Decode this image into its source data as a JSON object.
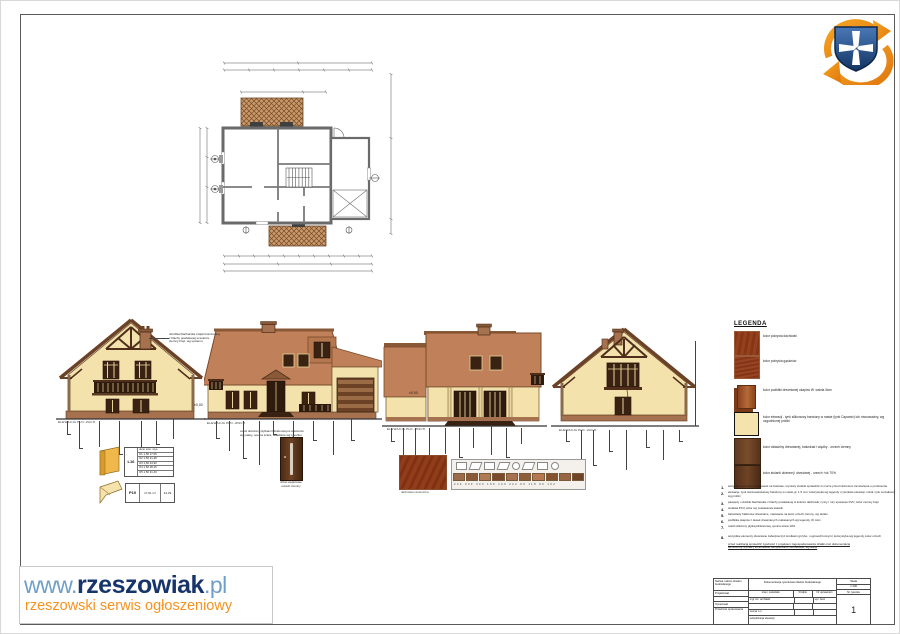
{
  "colors": {
    "roof": "#c0815a",
    "wall": "#f4e2ac",
    "timber": "#4f2f1b",
    "plinth": "#a5714e",
    "brand_navy": "#17356b",
    "brand_blue": "#6f9ec9",
    "brand_orange": "#f6921e"
  },
  "watermark": {
    "www": "www.",
    "brand": "rzeszowiak",
    "tld": ".pl",
    "tagline": "rzeszowski serwis ogłoszeniowy"
  },
  "legend": {
    "title": "LEGENDA",
    "items": [
      {
        "label": "kolor pokrycia dachówki"
      },
      {
        "label": "kolor pokrycia gąsiorów"
      },
      {
        "label": "kolor podbitki drewnianej okapów W. wiśnia /klon"
      },
      {
        "label": "kolor elewacji - tynk silikonowy barwiony w masie (tynk Capamix) lub równoważny, wg uzgodnionej próbki"
      },
      {
        "label": "kolor okładziny drewnianej, balustrad i więźby - orzech ciemny"
      },
      {
        "label": "kolor stolarki okiennej i drzwiowej - orzech +ok 70%"
      }
    ]
  },
  "notes": {
    "items": [
      {
        "num": "1.",
        "text": "wszystkie wymiary weryfikować na budowie; wymiary stolarki sprawdzić w murze przed złożeniem zamówienia u producenta"
      },
      {
        "num": "2.",
        "text": "elewacje: tynk cienkowarstwowy barwiony w masie gr. 1,5 mm; kolorystyka wg legendy i rysunków elewacji; cokół: tynk mozaikowy wg próbki"
      },
      {
        "num": "3.",
        "text": "parapety i obróbki blacharskie z blachy powlekanej w kolorze dachówki; rynny i rury spustowe PVC, kolor ciemny brąz"
      },
      {
        "num": "4.",
        "text": "stolarka PCV, kolor wg zestawienia stolarki"
      },
      {
        "num": "5.",
        "text": "balustrady balkonów drewniane, malowane na kolor orzech ciemny, wg detalu"
      },
      {
        "num": "6.",
        "text": "podbitka okapów z desek drewnianych malowanych wg legendy, W. klon"
      },
      {
        "num": "7.",
        "text": "cokół obłożony płytką klinkierową, spoina szara 10%"
      },
      {
        "num": "8.",
        "text": "wszystkie elementy drewniane zabezpieczyć środkami grzybo- i ognioochronnymi; kolorystyka wg legendy, kolor orzech"
      }
    ],
    "footer": [
      "przed realizacją sprawdzić zgodność z projektem zagospodarowania działki oraz dokumentacją",
      "techniczną; wymiary kontrolować bezpośrednio na budowie, wg stanu"
    ]
  },
  "titleblock": {
    "owner_header": "Nazwa i adres obiektu budowlanego",
    "doc_title": "Dokumentacja rysunkowa obiektu budowlanego",
    "scale_label": "Skala",
    "scale_value": "1:100",
    "col_name": "imię i nazwisko",
    "col_sign": "Podpis",
    "col_lic": "Nr uprawnień",
    "col_sheet": "Nr rysunku",
    "row1_label": "Projektował",
    "row1_name": "mgr inż. architekt",
    "row1_lic": "upr. bud.",
    "row3_label": "Opracował",
    "row3_name": "Lemar s.c.",
    "subject_label": "Przedmiot opracowania",
    "subject_value": "wizualizacja elewacji",
    "sheet_number": "1"
  },
  "elevations": {
    "e1": {
      "label": "ELEWACJA PŁN.-ZACH."
    },
    "e2": {
      "label": "ELEWACJA PŁN.-WSCH."
    },
    "e3": {
      "label": "ELEWACJA PŁD.-WSCH."
    },
    "e4": {
      "label": "ELEWACJA PŁD.-ZACH."
    },
    "level_zero": "±0,00",
    "ann_chimney": [
      "obróbka blacharska czapki kominowej,",
      "z blachy powlekanej w kolorze",
      "ciemny brąz, wg systemu"
    ],
    "ann_plinth": [
      "cokół obłożony płytkami klinkierowymi w kolorze",
      "wg palety, spoina szara, układanie wg rysunku"
    ]
  },
  "details": {
    "l16": {
      "code": "L16",
      "rows": [
        "okno   szer.  wys.",
        "O1   1,50   17,65",
        "O2   1,50   21,38",
        "O3   1,50   24,90",
        "O4   1,50   28,15",
        "O5   1,50   31,40"
      ]
    },
    "p10": {
      "code": "P10",
      "area": "17,61 m²",
      "val": "44,29"
    },
    "door": {
      "caption1": "drzwi wejściowe",
      "caption2": "orzech ciemny"
    },
    "strip": {
      "caption": "dachówka ceramiczna",
      "values": "240 330 333 190 103 222 90 118 96 102"
    }
  }
}
